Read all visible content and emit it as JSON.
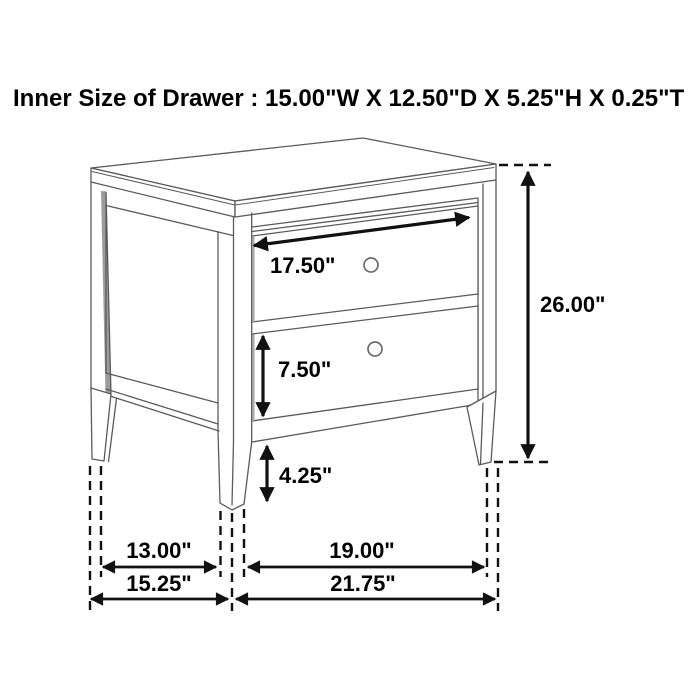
{
  "title": "Inner Size of Drawer : 15.00\"W X 12.50\"D X 5.25\"H X 0.25\"T",
  "labels": {
    "drawer_inner_width": "17.50\"",
    "drawer_front_height": "7.50\"",
    "leg_clearance": "4.25\"",
    "overall_height": "26.00\"",
    "side_leg_spacing": "13.00\"",
    "overall_depth": "15.25\"",
    "front_leg_spacing": "19.00\"",
    "overall_width": "21.75\""
  },
  "colors": {
    "background": "#ffffff",
    "furniture_line": "#5b5b5b",
    "dimension": "#111111",
    "text": "#000000",
    "shadow": "#9c9c9c"
  }
}
